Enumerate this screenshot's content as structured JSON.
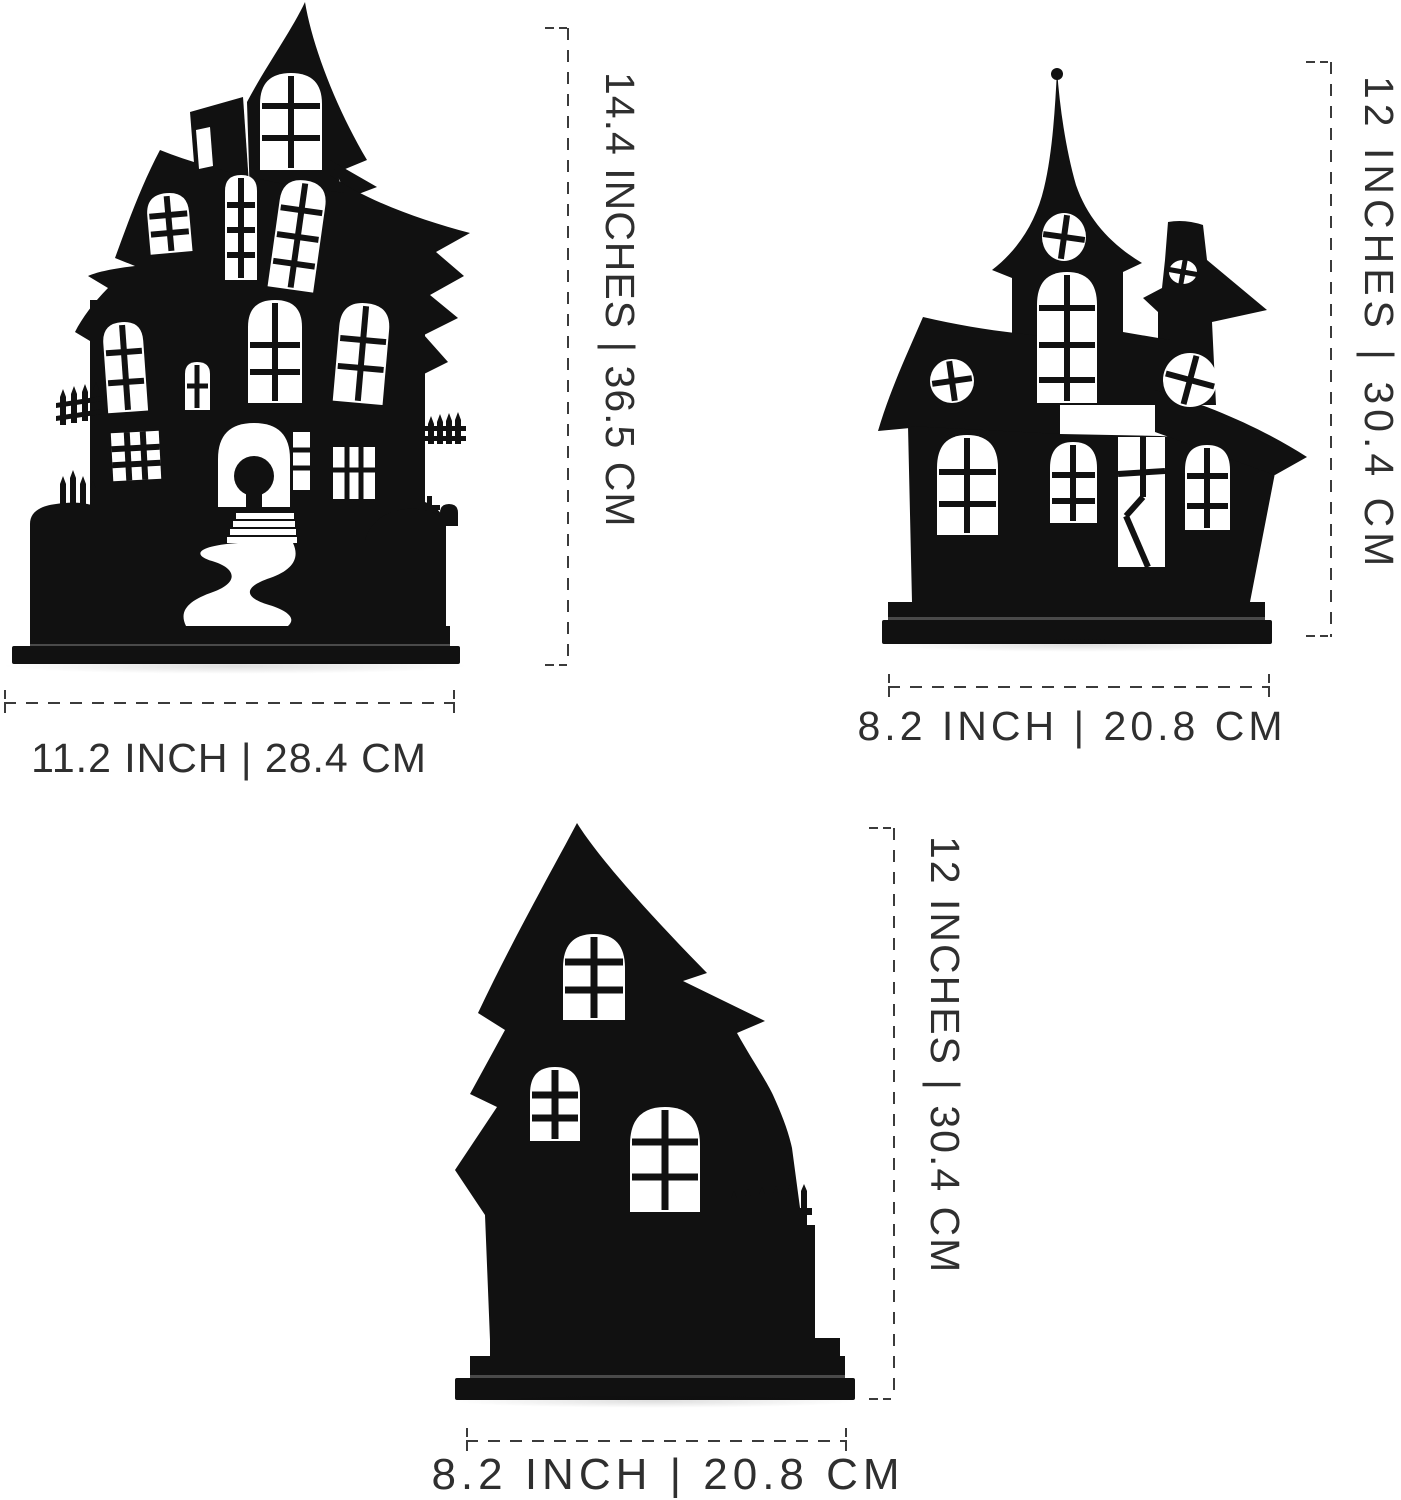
{
  "page": {
    "background_color": "#ffffff",
    "silhouette_color": "#111111",
    "dimension_line_color": "#3b3b3b",
    "dimension_text_color": "#2f2f2f",
    "description": "Product dimension diagram of three black haunted-house silhouette table decorations"
  },
  "figures": [
    {
      "name": "large-haunted-house",
      "height_label": "14.4 INCHES | 36.5 CM",
      "width_label": "11.2 INCH | 28.4 CM"
    },
    {
      "name": "spire-haunted-house",
      "height_label": "12 INCHES | 30.4 CM",
      "width_label": "8.2 INCH | 20.8 CM"
    },
    {
      "name": "crooked-haunted-house",
      "height_label": "12 INCHES | 30.4 CM",
      "width_label": "8.2 INCH | 20.8 CM"
    }
  ]
}
